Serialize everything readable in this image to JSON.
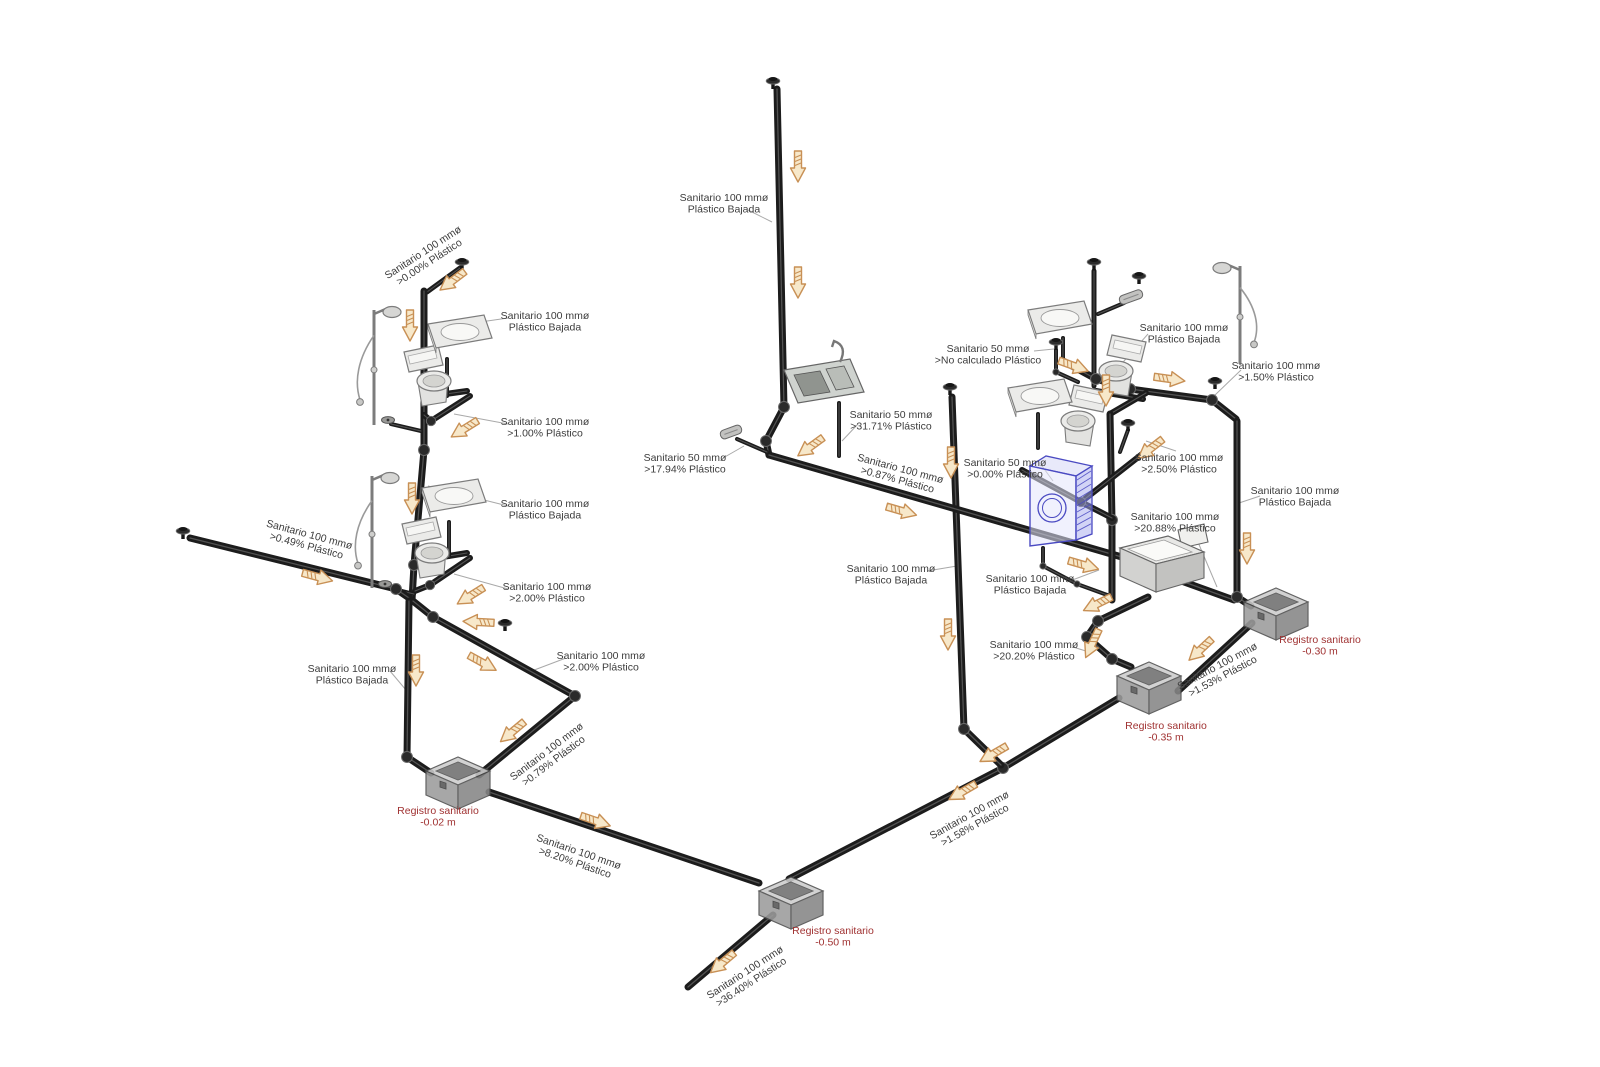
{
  "meta": {
    "description": "Isometric sanitary drainage piping diagram",
    "canvas": {
      "w": 1600,
      "h": 1067
    },
    "colors": {
      "bg": "#ffffff",
      "pipe": "#1c1c1c",
      "pipe_highlight": "#5d5d5d",
      "fitting_fill": "#2a2a2a",
      "fitting_edge": "#6a6a6a",
      "label_text": "#3c3c3c",
      "leader": "#a9a9a9",
      "registro_text": "#a03232",
      "arrow_fill": "#f7e8ca",
      "arrow_stroke": "#c89055",
      "fixture_stroke": "#7c7c7c",
      "fixture_fill": "#ebebe9",
      "washer_blue": "#4a4ac2",
      "box_top": "#cccccc",
      "box_front": "#9c9c9c",
      "box_side": "#868686",
      "box_edge": "#4d4d4d"
    }
  },
  "pipe_labels": [
    {
      "id": "bajada-top",
      "x": 724,
      "y": 203,
      "rot": 0,
      "lines": [
        "Sanitario 100 mmø",
        "Plástico Bajada"
      ]
    },
    {
      "id": "slope-0-00-left",
      "x": 426,
      "y": 257,
      "rot": -33,
      "lines": [
        "Sanitario 100 mmø",
        ">0.00% Plástico"
      ]
    },
    {
      "id": "bajada-bath1",
      "x": 545,
      "y": 321,
      "rot": 0,
      "lines": [
        "Sanitario 100 mmø",
        "Plástico Bajada"
      ]
    },
    {
      "id": "slope-1-00",
      "x": 545,
      "y": 427,
      "rot": 0,
      "lines": [
        "Sanitario 100 mmø",
        ">1.00% Plástico"
      ]
    },
    {
      "id": "bajada-bath2",
      "x": 545,
      "y": 509,
      "rot": 0,
      "lines": [
        "Sanitario 100 mmø",
        "Plástico Bajada"
      ]
    },
    {
      "id": "slope-2-00-a",
      "x": 547,
      "y": 592,
      "rot": 0,
      "lines": [
        "Sanitario 100 mmø",
        ">2.00% Plástico"
      ]
    },
    {
      "id": "slope-0-49",
      "x": 308,
      "y": 540,
      "rot": 15,
      "lines": [
        "Sanitario 100 mmø",
        ">0.49% Plástico"
      ]
    },
    {
      "id": "bajada-left",
      "x": 352,
      "y": 674,
      "rot": 0,
      "lines": [
        "Sanitario 100 mmø",
        "Plástico Bajada"
      ]
    },
    {
      "id": "slope-2-00-b",
      "x": 601,
      "y": 661,
      "rot": 0,
      "lines": [
        "Sanitario 100 mmø",
        ">2.00% Plástico"
      ]
    },
    {
      "id": "slope-0-79",
      "x": 550,
      "y": 756,
      "rot": -37,
      "lines": [
        "Sanitario 100 mmø",
        ">0.79% Plástico"
      ]
    },
    {
      "id": "slope-8-20",
      "x": 577,
      "y": 857,
      "rot": 19,
      "lines": [
        "Sanitario 100 mmø",
        ">8.20% Plástico"
      ]
    },
    {
      "id": "slope-36-40",
      "x": 748,
      "y": 977,
      "rot": -33,
      "lines": [
        "Sanitario 100 mmø",
        ">36.40% Plástico"
      ]
    },
    {
      "id": "slope-17-94",
      "x": 685,
      "y": 463,
      "rot": 0,
      "lines": [
        "Sanitario 50 mmø",
        ">17.94% Plástico"
      ]
    },
    {
      "id": "slope-31-71",
      "x": 891,
      "y": 420,
      "rot": 0,
      "lines": [
        "Sanitario 50 mmø",
        ">31.71% Plástico"
      ]
    },
    {
      "id": "slope-0-87",
      "x": 899,
      "y": 474,
      "rot": 15,
      "lines": [
        "Sanitario 100 mmø",
        ">0.87% Plástico"
      ]
    },
    {
      "id": "no-calculado",
      "x": 988,
      "y": 354,
      "rot": 0,
      "lines": [
        "Sanitario 50 mmø",
        ">No calculado Plástico"
      ]
    },
    {
      "id": "slope-0-00-wm",
      "x": 1005,
      "y": 468,
      "rot": 0,
      "lines": [
        "Sanitario 50 mmø",
        ">0.00% Plástico"
      ]
    },
    {
      "id": "bajada-bathr",
      "x": 1184,
      "y": 333,
      "rot": 0,
      "lines": [
        "Sanitario 100 mmø",
        "Plástico Bajada"
      ]
    },
    {
      "id": "slope-1-50",
      "x": 1276,
      "y": 371,
      "rot": 0,
      "lines": [
        "Sanitario 100 mmø",
        ">1.50% Plástico"
      ]
    },
    {
      "id": "slope-2-50",
      "x": 1179,
      "y": 463,
      "rot": 0,
      "lines": [
        "Sanitario 100 mmø",
        ">2.50% Plástico"
      ]
    },
    {
      "id": "slope-20-88",
      "x": 1175,
      "y": 522,
      "rot": 0,
      "lines": [
        "Sanitario 100 mmø",
        ">20.88% Plástico"
      ]
    },
    {
      "id": "bajada-right",
      "x": 1295,
      "y": 496,
      "rot": 0,
      "lines": [
        "Sanitario 100 mmø",
        "Plástico Bajada"
      ]
    },
    {
      "id": "bajada-mid",
      "x": 891,
      "y": 574,
      "rot": 0,
      "lines": [
        "Sanitario 100 mmø",
        "Plástico Bajada"
      ]
    },
    {
      "id": "bajada-laundry",
      "x": 1030,
      "y": 584,
      "rot": 0,
      "lines": [
        "Sanitario 100 mmø",
        "Plástico Bajada"
      ]
    },
    {
      "id": "slope-20-20",
      "x": 1034,
      "y": 650,
      "rot": 0,
      "lines": [
        "Sanitario 100 mmø",
        ">20.20% Plástico"
      ]
    },
    {
      "id": "slope-1-53",
      "x": 1220,
      "y": 671,
      "rot": -28,
      "lines": [
        "Sanitario 100 mmø",
        ">1.53% Plástico"
      ]
    },
    {
      "id": "slope-1-58",
      "x": 972,
      "y": 820,
      "rot": -29,
      "lines": [
        "Sanitario 100 mmø",
        ">1.58% Plástico"
      ]
    }
  ],
  "registros": [
    {
      "id": "registro-002",
      "x": 458,
      "y": 779,
      "lx": 438,
      "ly": 816,
      "lines": [
        "Registro sanitario",
        "-0.02 m"
      ]
    },
    {
      "id": "registro-050",
      "x": 791,
      "y": 899,
      "lx": 833,
      "ly": 936,
      "lines": [
        "Registro sanitario",
        "-0.50 m"
      ]
    },
    {
      "id": "registro-035",
      "x": 1149,
      "y": 684,
      "lx": 1166,
      "ly": 731,
      "lines": [
        "Registro sanitario",
        "-0.35 m"
      ]
    },
    {
      "id": "registro-030",
      "x": 1276,
      "y": 610,
      "lx": 1320,
      "ly": 645,
      "lines": [
        "Registro sanitario",
        "-0.30 m"
      ]
    }
  ],
  "pipes": [
    {
      "id": "vent-bath1",
      "w": 5,
      "pts": [
        [
          427,
          292
        ],
        [
          460,
          268
        ]
      ]
    },
    {
      "id": "stack-bath-left",
      "w": 7,
      "pts": [
        [
          424,
          291
        ],
        [
          424,
          450
        ],
        [
          414,
          565
        ],
        [
          412,
          600
        ]
      ]
    },
    {
      "id": "wc1-branch-a",
      "w": 6,
      "pts": [
        [
          424,
          397
        ],
        [
          467,
          391
        ]
      ]
    },
    {
      "id": "wc1-branch-b",
      "w": 6,
      "pts": [
        [
          470,
          396
        ],
        [
          431,
          421
        ],
        [
          424,
          415
        ]
      ]
    },
    {
      "id": "sink1-drain",
      "w": 4,
      "pts": [
        [
          447,
          359
        ],
        [
          447,
          396
        ]
      ]
    },
    {
      "id": "shower1-stub",
      "w": 4,
      "pts": [
        [
          391,
          424
        ],
        [
          421,
          431
        ]
      ]
    },
    {
      "id": "wc2-branch-a",
      "w": 6,
      "pts": [
        [
          424,
          560
        ],
        [
          467,
          553
        ]
      ]
    },
    {
      "id": "wc2-branch-b",
      "w": 6,
      "pts": [
        [
          470,
          558
        ],
        [
          430,
          585
        ],
        [
          415,
          591
        ]
      ]
    },
    {
      "id": "sink2-drain",
      "w": 4,
      "pts": [
        [
          449,
          522
        ],
        [
          449,
          557
        ]
      ]
    },
    {
      "id": "shower2-stub",
      "w": 4,
      "pts": [
        [
          389,
          588
        ],
        [
          414,
          594
        ]
      ]
    },
    {
      "id": "left-lateral",
      "w": 7,
      "pts": [
        [
          190,
          538
        ],
        [
          396,
          589
        ],
        [
          412,
          600
        ]
      ]
    },
    {
      "id": "bajada-to-002",
      "w": 7,
      "pts": [
        [
          409,
          601
        ],
        [
          407,
          757
        ],
        [
          431,
          773
        ]
      ]
    },
    {
      "id": "run-2-00",
      "w": 7,
      "pts": [
        [
          413,
          601
        ],
        [
          433,
          617
        ],
        [
          575,
          696
        ],
        [
          479,
          775
        ]
      ]
    },
    {
      "id": "run-8-20",
      "w": 7,
      "pts": [
        [
          489,
          792
        ],
        [
          759,
          883
        ]
      ]
    },
    {
      "id": "run-36-40",
      "w": 7,
      "pts": [
        [
          773,
          915
        ],
        [
          688,
          987
        ]
      ]
    },
    {
      "id": "main-run-c",
      "w": 7,
      "pts": [
        [
          1119,
          698
        ],
        [
          1003,
          768
        ],
        [
          789,
          879
        ]
      ]
    },
    {
      "id": "stack-mid",
      "w": 7,
      "pts": [
        [
          952,
          397
        ],
        [
          964,
          729
        ],
        [
          1001,
          765
        ]
      ]
    },
    {
      "id": "stack-top",
      "w": 7,
      "pts": [
        [
          777,
          89
        ],
        [
          784,
          407
        ],
        [
          766,
          441
        ],
        [
          769,
          455
        ]
      ]
    },
    {
      "id": "main-run-a",
      "w": 7,
      "pts": [
        [
          769,
          455
        ],
        [
          1146,
          564
        ]
      ]
    },
    {
      "id": "kitchen-drain",
      "w": 4,
      "pts": [
        [
          839,
          403
        ],
        [
          839,
          456
        ]
      ]
    },
    {
      "id": "run-17-94",
      "w": 4,
      "pts": [
        [
          737,
          439
        ],
        [
          767,
          452
        ]
      ]
    },
    {
      "id": "wm-drain",
      "w": 4,
      "pts": [
        [
          1043,
          548
        ],
        [
          1043,
          566
        ],
        [
          1077,
          584
        ],
        [
          1110,
          596
        ]
      ]
    },
    {
      "id": "no-calc-stub",
      "w": 4,
      "pts": [
        [
          1056,
          350
        ],
        [
          1056,
          372
        ],
        [
          1078,
          382
        ]
      ]
    },
    {
      "id": "stack-bathr-vent",
      "w": 5,
      "pts": [
        [
          1094,
          271
        ],
        [
          1094,
          386
        ]
      ]
    },
    {
      "id": "showerr-stub",
      "w": 4,
      "pts": [
        [
          1124,
          303
        ],
        [
          1098,
          314
        ]
      ]
    },
    {
      "id": "collector-right",
      "w": 7,
      "pts": [
        [
          1063,
          361
        ],
        [
          1096,
          379
        ],
        [
          1130,
          389
        ],
        [
          1212,
          400
        ],
        [
          1236,
          419
        ]
      ]
    },
    {
      "id": "sinkr1-drain",
      "w": 4,
      "pts": [
        [
          1063,
          338
        ],
        [
          1063,
          361
        ]
      ]
    },
    {
      "id": "wcr1-branch-a",
      "w": 6,
      "pts": [
        [
          1096,
          391
        ],
        [
          1143,
          399
        ]
      ]
    },
    {
      "id": "wcr1-branch-b",
      "w": 6,
      "pts": [
        [
          1146,
          393
        ],
        [
          1110,
          414
        ]
      ]
    },
    {
      "id": "bajada-1112",
      "w": 7,
      "pts": [
        [
          1110,
          414
        ],
        [
          1112,
          520
        ],
        [
          1112,
          600
        ]
      ]
    },
    {
      "id": "run-2-50",
      "w": 6,
      "pts": [
        [
          1160,
          440
        ],
        [
          1081,
          502
        ]
      ]
    },
    {
      "id": "vent-2-50-stub",
      "w": 4,
      "pts": [
        [
          1128,
          430
        ],
        [
          1120,
          452
        ]
      ]
    },
    {
      "id": "wcr2-branch",
      "w": 6,
      "pts": [
        [
          1022,
          470
        ],
        [
          1081,
          502
        ],
        [
          1112,
          518
        ]
      ]
    },
    {
      "id": "sinkr2-drain",
      "w": 4,
      "pts": [
        [
          1038,
          414
        ],
        [
          1038,
          448
        ]
      ]
    },
    {
      "id": "run-20-88",
      "w": 7,
      "pts": [
        [
          1148,
          569
        ],
        [
          1234,
          600
        ]
      ]
    },
    {
      "id": "run-20-20",
      "w": 7,
      "pts": [
        [
          1148,
          597
        ],
        [
          1098,
          621
        ],
        [
          1087,
          637
        ],
        [
          1112,
          659
        ],
        [
          1131,
          667
        ]
      ]
    },
    {
      "id": "stack-right",
      "w": 7,
      "pts": [
        [
          1237,
          421
        ],
        [
          1237,
          597
        ],
        [
          1251,
          606
        ]
      ]
    },
    {
      "id": "run-1-53",
      "w": 7,
      "pts": [
        [
          1252,
          623
        ],
        [
          1178,
          691
        ]
      ]
    }
  ],
  "leaders": [
    [
      748,
      210,
      772,
      222
    ],
    [
      508,
      318,
      432,
      329
    ],
    [
      508,
      424,
      454,
      414
    ],
    [
      508,
      506,
      428,
      486
    ],
    [
      508,
      589,
      454,
      574
    ],
    [
      390,
      671,
      406,
      690
    ],
    [
      566,
      658,
      529,
      672
    ],
    [
      723,
      458,
      744,
      446
    ],
    [
      858,
      424,
      842,
      441
    ],
    [
      1034,
      351,
      1054,
      349
    ],
    [
      1042,
      466,
      1053,
      481
    ],
    [
      1148,
      334,
      1109,
      378
    ],
    [
      1241,
      370,
      1214,
      396
    ],
    [
      1176,
      451,
      1146,
      441
    ],
    [
      1192,
      528,
      1217,
      587
    ],
    [
      1260,
      496,
      1239,
      503
    ],
    [
      927,
      571,
      957,
      566
    ],
    [
      1067,
      582,
      1099,
      570
    ],
    [
      1073,
      647,
      1089,
      652
    ]
  ],
  "arrows": [
    [
      798,
      167,
      90
    ],
    [
      798,
      283,
      90
    ],
    [
      452,
      281,
      143
    ],
    [
      410,
      326,
      90
    ],
    [
      464,
      429,
      148
    ],
    [
      412,
      499,
      90
    ],
    [
      470,
      596,
      148
    ],
    [
      478,
      622,
      183
    ],
    [
      318,
      577,
      15
    ],
    [
      483,
      663,
      29
    ],
    [
      512,
      732,
      140
    ],
    [
      416,
      671,
      90
    ],
    [
      596,
      821,
      19
    ],
    [
      722,
      963,
      140
    ],
    [
      951,
      463,
      90
    ],
    [
      948,
      635,
      90
    ],
    [
      993,
      754,
      150
    ],
    [
      962,
      792,
      150
    ],
    [
      902,
      511,
      16
    ],
    [
      810,
      447,
      144
    ],
    [
      1074,
      366,
      20
    ],
    [
      1170,
      379,
      8
    ],
    [
      1106,
      391,
      90
    ],
    [
      1150,
      449,
      142
    ],
    [
      1084,
      565,
      16
    ],
    [
      1097,
      604,
      154
    ],
    [
      1092,
      644,
      115
    ],
    [
      1247,
      549,
      90
    ],
    [
      1200,
      650,
      137
    ]
  ],
  "fixtures": {
    "showers": [
      {
        "x": 374,
        "y": 310,
        "h": 115,
        "side": 1
      },
      {
        "x": 372,
        "y": 476,
        "h": 112,
        "side": 1
      },
      {
        "x": 1240,
        "y": 266,
        "h": 98,
        "side": -1
      }
    ],
    "toilets": [
      {
        "x": 404,
        "y": 352,
        "flip": 1
      },
      {
        "x": 402,
        "y": 524,
        "flip": 1
      },
      {
        "x": 1146,
        "y": 342,
        "flip": -1
      },
      {
        "x": 1108,
        "y": 392,
        "flip": -1
      }
    ],
    "wall_sinks": [
      {
        "x": 458,
        "y": 336
      },
      {
        "x": 452,
        "y": 500
      },
      {
        "x": 1058,
        "y": 322
      },
      {
        "x": 1038,
        "y": 400
      }
    ],
    "kitchen_sink": {
      "x": 822,
      "y": 384
    },
    "laundry_sink": {
      "x": 1160,
      "y": 566
    },
    "washing_machine": {
      "x": 1060,
      "y": 502
    },
    "floor_drain_plates": [
      {
        "x": 731,
        "y": 432,
        "rot": -20,
        "len": 22
      },
      {
        "x": 1131,
        "y": 297,
        "rot": -20,
        "len": 24
      }
    ],
    "small_drains": [
      {
        "x": 388,
        "y": 420
      },
      {
        "x": 385,
        "y": 584
      }
    ],
    "vent_caps": [
      {
        "x": 462,
        "y": 263
      },
      {
        "x": 773,
        "y": 82
      },
      {
        "x": 950,
        "y": 388
      },
      {
        "x": 1094,
        "y": 263
      },
      {
        "x": 1139,
        "y": 277
      },
      {
        "x": 1215,
        "y": 382
      },
      {
        "x": 1128,
        "y": 424
      },
      {
        "x": 1056,
        "y": 343
      },
      {
        "x": 183,
        "y": 532
      },
      {
        "x": 505,
        "y": 624
      }
    ]
  }
}
